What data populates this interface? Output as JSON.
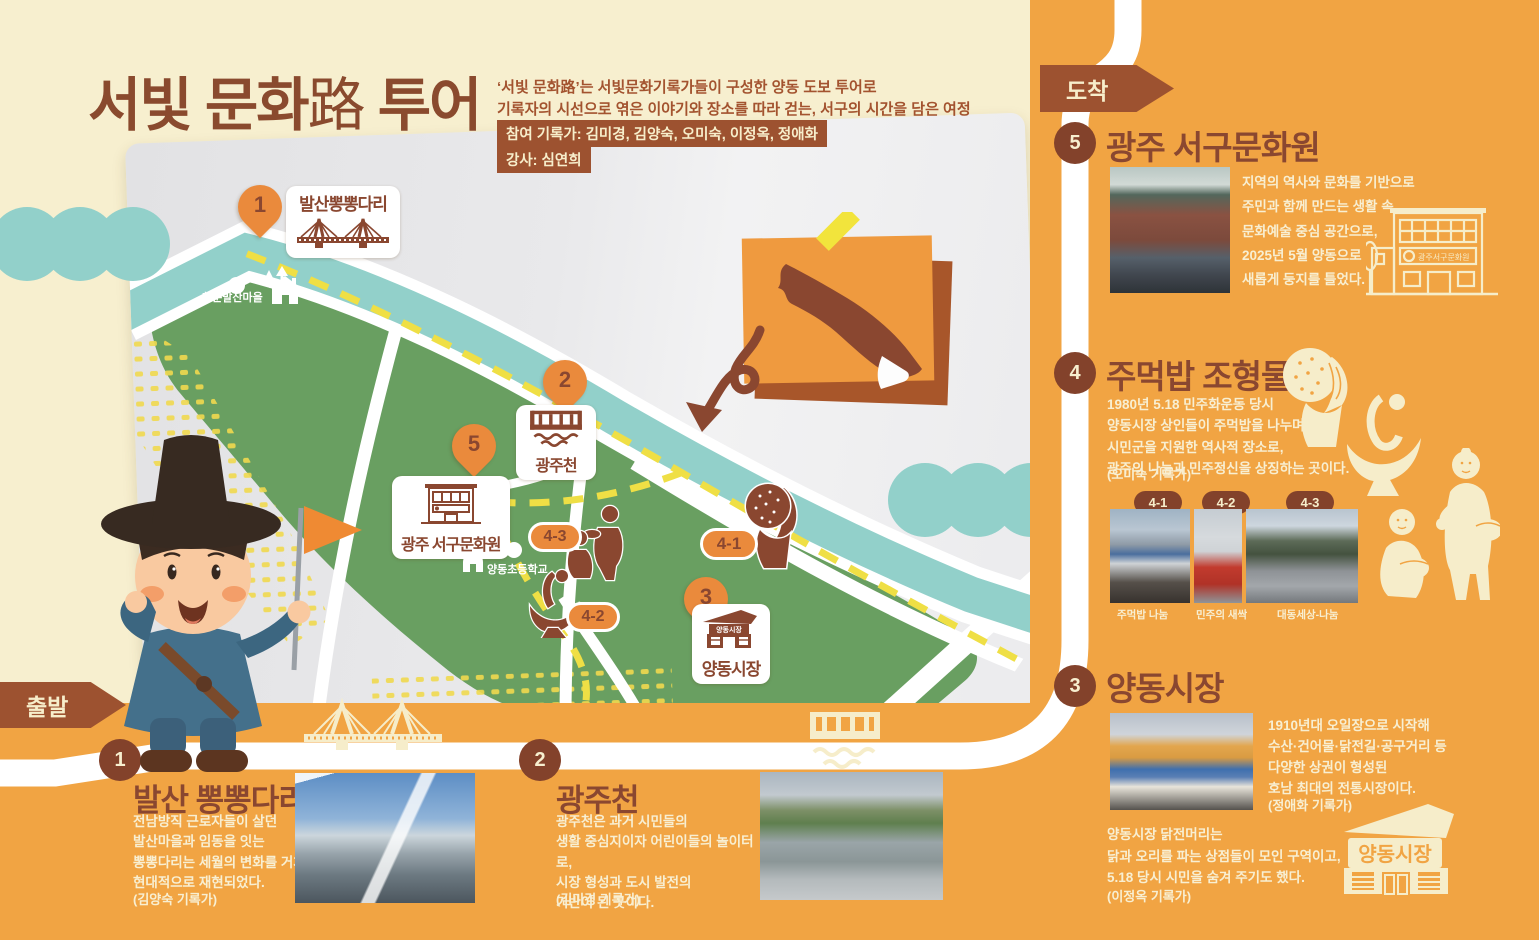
{
  "header": {
    "title_part1": "서빛 문화",
    "title_han": "路",
    "title_part2": " 투어",
    "desc1": "‘서빛 문화路’는 서빛문화기록가들이 구성한 양동 도보 투어로",
    "desc2": "기록자의 시선으로 엮은 이야기와 장소를 따라 걷는, 서구의 시간을 담은 여정",
    "badge_recorders": "참여 기록가: 김미경, 김양숙, 오미숙, 이정옥, 정애화",
    "badge_instructor": "강사: 심연희"
  },
  "rail": {
    "start": "출발",
    "end": "도착",
    "nums": [
      "1",
      "2",
      "3",
      "4",
      "5"
    ]
  },
  "map": {
    "village": "청춘발산마을",
    "school": "양동초등학교",
    "pin1_num": "1",
    "pin1_label": "발산뽕뽕다리",
    "pin2_num": "2",
    "pin2_label": "광주천",
    "pin3_num": "3",
    "pin3_label": "양동시장",
    "pin3_sign": "양동시장",
    "pin5_num": "5",
    "pin5_label": "광주 서구문화원",
    "oval41": "4-1",
    "oval42": "4-2",
    "oval43": "4-3"
  },
  "stops": {
    "s1": {
      "name": "발산 뽕뽕다리",
      "desc": "전남방직 근로자들이 살던\n발산마을과 임동을 잇는\n뽕뽕다리는 세월의 변화를 거쳐\n현대적으로 재현되었다.",
      "credit": "(김양숙 기록가)"
    },
    "s2": {
      "name": "광주천",
      "desc": "광주천은 과거 시민들의\n생활 중심지이자 어린이들의 놀이터로,\n시장 형성과 도시 발전의\n기반이 된 곳이다.",
      "credit": "(김미경 기록가)"
    },
    "s3": {
      "name": "양동시장",
      "desc": "1910년대 오일장으로 시작해\n수산·건어물·닭전길·공구거리 등\n다양한 상권이 형성된\n호남 최대의 전통시장이다.",
      "credit": "(정애화 기록가)",
      "desc2": "양동시장 닭전머리는\n닭과 오리를 파는 상점들이 모인 구역이고,\n5.18 당시 시민을 숨겨 주기도 했다.",
      "credit2": "(이정옥 기록가)",
      "illus_label": "양동시장"
    },
    "s4": {
      "name": "주먹밥 조형물",
      "desc": "1980년 5.18 민주화운동 당시\n양동시장 상인들이 주먹밥을 나누며\n시민군을 지원한 역사적 장소로,\n광주의 나눔과 민주정신을 상징하는 곳이다.",
      "credit": "(오미숙 기록가)",
      "b1": "4-1",
      "b2": "4-2",
      "b3": "4-3",
      "cap1": "주먹밥 나눔",
      "cap2": "민주의 새싹",
      "cap3": "대동세상-나눔"
    },
    "s5": {
      "name": "광주 서구문화원",
      "desc": "지역의 역사와 문화를 기반으로\n주민과 함께 만드는 생활 속\n문화예술 중심 공간으로,\n2025년 5월 양동으로\n새롭게 둥지를 틀었다.",
      "illus_label": "광주서구문화원"
    }
  },
  "colors": {
    "orange": "#f1a443",
    "brown": "#8a4730",
    "badge_brown": "#9d5230",
    "cream": "#f7efcf",
    "teal": "#92d0ca",
    "green": "#699f61",
    "route_yellow": "#efdf45",
    "pin_orange": "#ea8a3c"
  }
}
